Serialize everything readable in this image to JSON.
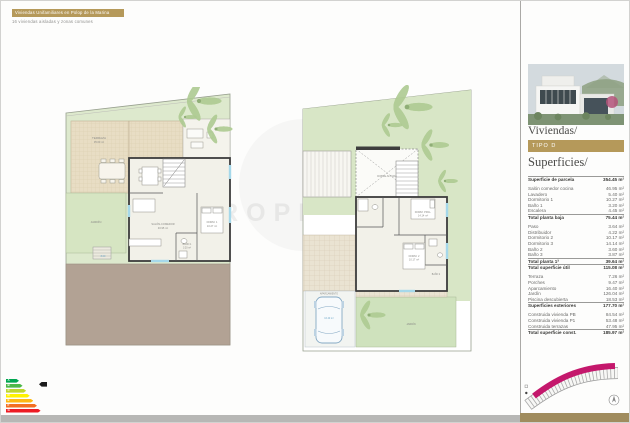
{
  "header": {
    "title": "Viviendas Unifamiliares en Polop de la Marina",
    "subtitle": "16 viviendas aisladas y zonas comunes"
  },
  "watermark": "PROPERTIES",
  "colors": {
    "accent_gold": "#b5995a",
    "magenta": "#c4186c",
    "garden_green": "#d8e6c6",
    "deck_tan": "#e8ddc4",
    "driveway_taupe": "#b2a294",
    "wall_dark": "#3c3c3c",
    "window_cyan": "#a5d8ea"
  },
  "sidebar": {
    "section1_title": "Viviendas/",
    "tipo_label": "TIPO D",
    "section2_title": "Superficies/",
    "surfaces": [
      {
        "label": "Superficie de parcela",
        "value": "354.45 m²",
        "bold": true,
        "gap": true
      },
      {
        "label": "Salón comedor cocina",
        "value": "46.95 m²"
      },
      {
        "label": "Lavadero",
        "value": "5.40 m²"
      },
      {
        "label": "Dormitorio 1",
        "value": "10.27 m²"
      },
      {
        "label": "Baño 1",
        "value": "3.20 m²"
      },
      {
        "label": "Escalera",
        "value": "4.45 m²"
      },
      {
        "label": "Total planta baja",
        "value": "75.44 m²",
        "bold": true,
        "gap": true
      },
      {
        "label": "Paso",
        "value": "3.64 m²"
      },
      {
        "label": "Distribuidor",
        "value": "4.22 m²"
      },
      {
        "label": "Dormitorio 2",
        "value": "10.17 m²"
      },
      {
        "label": "Dormitorio 3",
        "value": "14.14 m²"
      },
      {
        "label": "Baño 2",
        "value": "3.60 m²"
      },
      {
        "label": "Baño 3",
        "value": "3.87 m²"
      },
      {
        "label": "Total planta 1ª",
        "value": "39.64 m²",
        "bold": true
      },
      {
        "label": "Total superficie útil",
        "value": "115.08 m²",
        "bold": true,
        "gap": true
      },
      {
        "label": "Terraza",
        "value": "7.26 m²"
      },
      {
        "label": "Porches",
        "value": "9.47 m²"
      },
      {
        "label": "Aparcamiento",
        "value": "16.40 m²"
      },
      {
        "label": "Jardín",
        "value": "126.04 m²"
      },
      {
        "label": "Piscina descubierta",
        "value": "18.53 m²"
      },
      {
        "label": "Superficies exteriores",
        "value": "177.70 m²",
        "bold": true,
        "gap": true
      },
      {
        "label": "Construida vivienda PB",
        "value": "84.54 m²"
      },
      {
        "label": "Construida vivienda P1",
        "value": "53.48 m²"
      },
      {
        "label": "Construida terrazas",
        "value": "47.95 m²"
      },
      {
        "label": "Total superficie const.",
        "value": "185.97 m²",
        "bold": true
      }
    ]
  },
  "plans": {
    "left": {
      "terraza": "TERRAZA",
      "terraza_area": "35.60 m²",
      "jardin": "JARDÍN",
      "salon": "SALÓN-COMEDOR",
      "salon_area": "46.95 m²",
      "dorm1": "DORM. 1",
      "dorm1_area": "10.27 m²",
      "bano1": "BAÑO 1",
      "bano1_area": "3.20 m²",
      "dim1": "8.00"
    },
    "right": {
      "doble_altura": "DOBLE ALTURA",
      "dorm_ppal": "DORM. PPAL.",
      "dorm_ppal_area": "14.14 m²",
      "dorm2": "DORM. 2",
      "dorm2_area": "10.17 m²",
      "bano2": "BAÑO 2",
      "jardin": "JARDÍN",
      "aparcamiento": "APARCAMIENTO",
      "aparcamiento_area": "16.40 m²"
    }
  },
  "energy": {
    "bars": [
      {
        "letter": "A",
        "color": "#00a650"
      },
      {
        "letter": "B",
        "color": "#4db848"
      },
      {
        "letter": "C",
        "color": "#bed62f"
      },
      {
        "letter": "D",
        "color": "#fff200"
      },
      {
        "letter": "E",
        "color": "#fdb913"
      },
      {
        "letter": "F",
        "color": "#f36f21"
      },
      {
        "letter": "G",
        "color": "#ed1c24"
      }
    ]
  }
}
